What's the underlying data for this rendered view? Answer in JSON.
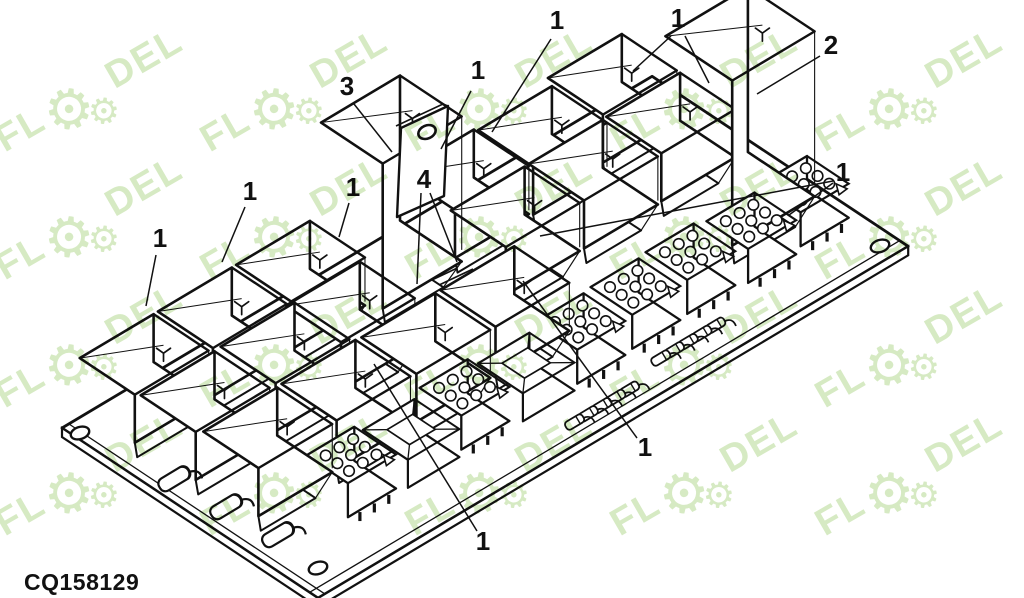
{
  "title": "CQ158129 relay board parts diagram",
  "part_code": {
    "text": "CQ158129"
  },
  "watermark": {
    "text_left": "FL",
    "text_right": "DEL",
    "gear_glyph": "⚙",
    "color": "#d6eac3",
    "angle_deg": -30,
    "grid": {
      "x0": 95,
      "y0": 100,
      "dx": 205,
      "dy": 128,
      "cols": 5,
      "rows": 4
    }
  },
  "callouts": [
    {
      "label": "3",
      "x": 347,
      "y": 86,
      "leaders": [
        [
          [
            354,
            104
          ],
          [
            392,
            152
          ]
        ]
      ]
    },
    {
      "label": "1",
      "x": 478,
      "y": 70,
      "leaders": [
        [
          [
            471,
            91
          ],
          [
            441,
            149
          ]
        ]
      ]
    },
    {
      "label": "1",
      "x": 557,
      "y": 20,
      "leaders": [
        [
          [
            551,
            39
          ],
          [
            492,
            132
          ]
        ]
      ]
    },
    {
      "label": "1",
      "x": 678,
      "y": 18,
      "leaders": [
        [
          [
            671,
            36
          ],
          [
            633,
            71
          ]
        ],
        [
          [
            685,
            36
          ],
          [
            709,
            83
          ]
        ]
      ]
    },
    {
      "label": "2",
      "x": 831,
      "y": 45,
      "leaders": [
        [
          [
            820,
            56
          ],
          [
            757,
            94
          ]
        ]
      ]
    },
    {
      "label": "1",
      "x": 843,
      "y": 172,
      "leaders": [
        [
          [
            833,
            181
          ],
          [
            540,
            236
          ]
        ],
        [
          [
            833,
            183
          ],
          [
            789,
            215
          ]
        ]
      ]
    },
    {
      "label": "1",
      "x": 250,
      "y": 191,
      "leaders": [
        [
          [
            245,
            207
          ],
          [
            222,
            262
          ]
        ]
      ]
    },
    {
      "label": "1",
      "x": 353,
      "y": 187,
      "leaders": [
        [
          [
            349,
            203
          ],
          [
            339,
            237
          ]
        ]
      ]
    },
    {
      "label": "1",
      "x": 160,
      "y": 238,
      "leaders": [
        [
          [
            156,
            255
          ],
          [
            146,
            306
          ]
        ]
      ]
    },
    {
      "label": "4",
      "x": 424,
      "y": 179,
      "leaders": [
        [
          [
            421,
            193
          ],
          [
            417,
            284
          ]
        ],
        [
          [
            430,
            193
          ],
          [
            457,
            262
          ]
        ]
      ]
    },
    {
      "label": "1",
      "x": 645,
      "y": 447,
      "leaders": [
        [
          [
            637,
            438
          ],
          [
            523,
            281
          ]
        ]
      ]
    },
    {
      "label": "1",
      "x": 483,
      "y": 541,
      "leaders": [
        [
          [
            477,
            531
          ],
          [
            374,
            364
          ]
        ]
      ]
    }
  ],
  "diagram": {
    "line_color": "#111111",
    "fill_color": "#ffffff",
    "board": {
      "origin": [
        62,
        428
      ],
      "u": [
        0.859,
        -0.512
      ],
      "v": [
        0.834,
        0.554
      ],
      "len_u": 687,
      "len_v": 307,
      "thickness": 9,
      "holes": [
        [
          80,
          433
        ],
        [
          318,
          568
        ],
        [
          880,
          246
        ]
      ]
    },
    "relays": [
      [
        51,
        46
      ],
      [
        142,
        46
      ],
      [
        233,
        46
      ],
      [
        418,
        52
      ],
      [
        506,
        55
      ],
      [
        597,
        45
      ],
      [
        54,
        116
      ],
      [
        148,
        115
      ],
      [
        226,
        113
      ],
      [
        415,
        116
      ],
      [
        506,
        116
      ],
      [
        597,
        115
      ],
      [
        59,
        186
      ],
      [
        151,
        185
      ],
      [
        243,
        186
      ],
      [
        335,
        186
      ]
    ],
    "tall_relays": [
      {
        "pos": [
          330,
          55
        ],
        "h": 145,
        "tag": true,
        "ref": "3"
      },
      {
        "pos": [
          600,
          195
        ],
        "h": 165,
        "tag": false,
        "ref": "2"
      }
    ],
    "connectors": [
      [
        121,
        222
      ],
      [
        253,
        222
      ],
      [
        385,
        225
      ],
      [
        451,
        223
      ],
      [
        517,
        221
      ],
      [
        583,
        226
      ],
      [
        649,
        221
      ]
    ],
    "empty_sockets": [
      [
        187,
        226
      ],
      [
        319,
        228
      ]
    ],
    "diodes_small": [
      [
        320,
        285
      ],
      [
        336,
        285
      ],
      [
        352,
        285
      ],
      [
        368,
        285
      ],
      [
        384,
        285
      ],
      [
        432,
        273
      ],
      [
        448,
        273
      ],
      [
        464,
        273
      ],
      [
        480,
        273
      ],
      [
        496,
        273
      ]
    ],
    "capsules": [
      [
        22,
        112
      ],
      [
        28,
        168
      ],
      [
        34,
        224
      ]
    ],
    "tag_plate": {
      "poly": [
        [
          401,
          128
        ],
        [
          448,
          106
        ],
        [
          444,
          196
        ],
        [
          397,
          217
        ]
      ],
      "hole": [
        427,
        132
      ]
    },
    "rails": [
      [
        [
          398,
          296
        ],
        [
          470,
          262
        ]
      ],
      [
        [
          401,
          303
        ],
        [
          473,
          269
        ]
      ]
    ]
  }
}
